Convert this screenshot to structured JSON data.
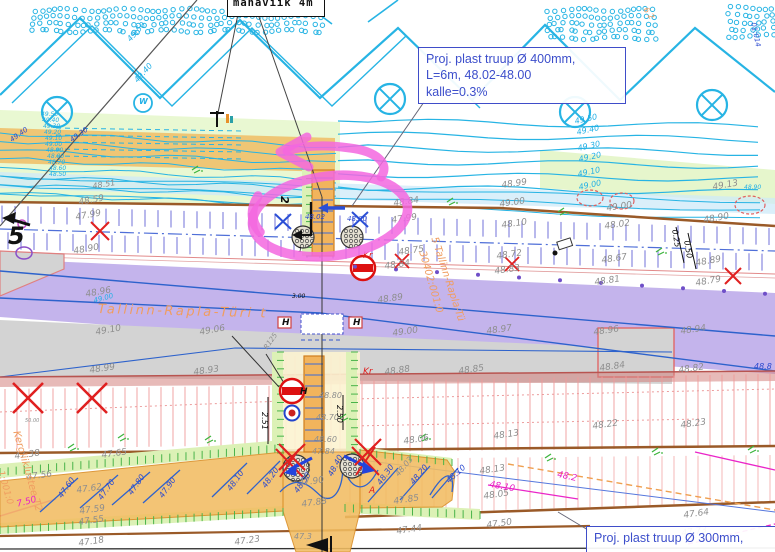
{
  "title_box": {
    "text": "mahaviik 4m"
  },
  "callout_400": {
    "line1": "Proj. plast truup Ø 400mm,",
    "line2": "L=6m, 48.02-48.00",
    "line3": "kalle=0.3%"
  },
  "callout_300": {
    "text": "Proj. plast truup Ø 300mm,"
  },
  "palette": {
    "gray_text": "#8e8e8e",
    "contour_cyan": "#23b0e6",
    "blue_text": "#2b49cf",
    "orange_text": "#f09d60",
    "red_text": "#e02020",
    "black_text": "#111111",
    "magenta_text": "#e822c6",
    "pink_annotation": "#f367df",
    "purple_road": "#b7a3e8",
    "orange_road": "#f2bd62",
    "gray_surface": "#d3d3d3",
    "callout_blue": "#3c4ecb"
  },
  "road_names": {
    "main_road": "Tallinn-Rapla-Türi t",
    "main_road_diagonal": "5 Tallinn-Rapla-Tü",
    "cadastral_main": "30402:001:0",
    "light_traffic_road": "Kergliiklustee T2",
    "cadastral_left": "1:001:0"
  },
  "labels": [
    {
      "t": "48.59",
      "x": 78,
      "y": 199,
      "c": "g",
      "r": -10
    },
    {
      "t": "47.99",
      "x": 75,
      "y": 214,
      "c": "g",
      "r": -10
    },
    {
      "t": "48.90",
      "x": 73,
      "y": 248,
      "c": "g",
      "r": -10
    },
    {
      "t": "48.96",
      "x": 85,
      "y": 291,
      "c": "g",
      "r": -10
    },
    {
      "t": "49.10",
      "x": 95,
      "y": 329,
      "c": "g",
      "r": -10
    },
    {
      "t": "49.06",
      "x": 199,
      "y": 329,
      "c": "g",
      "r": -10
    },
    {
      "t": "48.99",
      "x": 89,
      "y": 367,
      "c": "g",
      "r": -8
    },
    {
      "t": "48.93",
      "x": 193,
      "y": 369,
      "c": "g",
      "r": -8
    },
    {
      "t": "48.51",
      "x": 92,
      "y": 183,
      "c": "g",
      "s": 8,
      "r": -10
    },
    {
      "t": "48.89",
      "x": 377,
      "y": 297,
      "c": "g",
      "r": -8
    },
    {
      "t": "49.00",
      "x": 392,
      "y": 330,
      "c": "g",
      "r": -8
    },
    {
      "t": "48.97",
      "x": 486,
      "y": 328,
      "c": "g",
      "r": -8
    },
    {
      "t": "48.96",
      "x": 593,
      "y": 329,
      "c": "g",
      "r": -8
    },
    {
      "t": "48.99",
      "x": 501,
      "y": 182,
      "c": "g",
      "r": -8
    },
    {
      "t": "49.00",
      "x": 499,
      "y": 201,
      "c": "g",
      "r": -8
    },
    {
      "t": "49.00",
      "x": 606,
      "y": 205,
      "c": "g",
      "r": -8
    },
    {
      "t": "48.10",
      "x": 501,
      "y": 222,
      "c": "g",
      "r": -8
    },
    {
      "t": "48.02",
      "x": 604,
      "y": 223,
      "c": "g",
      "r": -8
    },
    {
      "t": "48.72",
      "x": 496,
      "y": 253,
      "c": "g",
      "r": -8
    },
    {
      "t": "48.75",
      "x": 398,
      "y": 249,
      "c": "g",
      "r": -8
    },
    {
      "t": "47.99",
      "x": 391,
      "y": 217,
      "c": "g",
      "r": -8
    },
    {
      "t": "48.84",
      "x": 393,
      "y": 200,
      "c": "g",
      "r": -8
    },
    {
      "t": "48.84",
      "x": 384,
      "y": 263,
      "c": "g",
      "r": -8
    },
    {
      "t": "48.83",
      "x": 494,
      "y": 268,
      "c": "g",
      "r": -8
    },
    {
      "t": "48.67",
      "x": 601,
      "y": 257,
      "c": "g",
      "r": -8
    },
    {
      "t": "49.13",
      "x": 712,
      "y": 184,
      "c": "g",
      "r": -10
    },
    {
      "t": "48.90",
      "x": 703,
      "y": 217,
      "c": "g",
      "r": -10
    },
    {
      "t": "48.89",
      "x": 695,
      "y": 260,
      "c": "g",
      "r": -10
    },
    {
      "t": "48.79",
      "x": 695,
      "y": 280,
      "c": "g",
      "r": -10
    },
    {
      "t": "48.81",
      "x": 594,
      "y": 279,
      "c": "g",
      "r": -8
    },
    {
      "t": "48.94",
      "x": 680,
      "y": 328,
      "c": "g",
      "r": -8
    },
    {
      "t": "48.84",
      "x": 599,
      "y": 365,
      "c": "g",
      "r": -8
    },
    {
      "t": "48.82",
      "x": 678,
      "y": 367,
      "c": "g",
      "r": -8
    },
    {
      "t": "48.88",
      "x": 384,
      "y": 369,
      "c": "g",
      "r": -8
    },
    {
      "t": "48.85",
      "x": 458,
      "y": 368,
      "c": "g",
      "r": -8
    },
    {
      "t": "48.80",
      "x": 319,
      "y": 392,
      "c": "g",
      "s": 8
    },
    {
      "t": "48.70",
      "x": 316,
      "y": 414,
      "c": "g",
      "s": 8
    },
    {
      "t": "48.60",
      "x": 314,
      "y": 436,
      "c": "g",
      "s": 8
    },
    {
      "t": "47.84",
      "x": 312,
      "y": 448,
      "c": "g",
      "s": 8
    },
    {
      "t": "47.90",
      "x": 298,
      "y": 480,
      "c": "g",
      "r": -8
    },
    {
      "t": "47.88",
      "x": 301,
      "y": 501,
      "c": "g",
      "r": -8
    },
    {
      "t": "47.85",
      "x": 393,
      "y": 498,
      "c": "g",
      "r": -8
    },
    {
      "t": "47.44",
      "x": 396,
      "y": 528,
      "c": "g",
      "r": -8
    },
    {
      "t": "47.50",
      "x": 486,
      "y": 522,
      "c": "g",
      "r": -8
    },
    {
      "t": "48.06",
      "x": 403,
      "y": 438,
      "c": "g",
      "r": -8
    },
    {
      "t": "48.13",
      "x": 493,
      "y": 433,
      "c": "g",
      "r": -8
    },
    {
      "t": "48.13",
      "x": 479,
      "y": 468,
      "c": "g",
      "r": -8
    },
    {
      "t": "48.05",
      "x": 483,
      "y": 493,
      "c": "g",
      "r": -8
    },
    {
      "t": "48.23",
      "x": 680,
      "y": 422,
      "c": "g",
      "r": -8
    },
    {
      "t": "48.22",
      "x": 592,
      "y": 423,
      "c": "g",
      "r": -8
    },
    {
      "t": "47.38",
      "x": 14,
      "y": 453,
      "c": "g",
      "r": -8
    },
    {
      "t": "47.65",
      "x": 101,
      "y": 452,
      "c": "g",
      "r": -8
    },
    {
      "t": "47.56",
      "x": 26,
      "y": 474,
      "c": "g",
      "r": -8
    },
    {
      "t": "47.62",
      "x": 76,
      "y": 487,
      "c": "g",
      "r": -8
    },
    {
      "t": "47.59",
      "x": 79,
      "y": 508,
      "c": "g",
      "r": -8
    },
    {
      "t": "47.55",
      "x": 78,
      "y": 519,
      "c": "g",
      "r": -8
    },
    {
      "t": "47.18",
      "x": 78,
      "y": 540,
      "c": "g",
      "r": -8
    },
    {
      "t": "47.23",
      "x": 234,
      "y": 539,
      "c": "g",
      "r": -8
    },
    {
      "t": "47.64",
      "x": 683,
      "y": 512,
      "c": "g",
      "r": -8
    },
    {
      "t": "47.73",
      "x": 681,
      "y": 530,
      "c": "g",
      "r": -8
    },
    {
      "t": "50.00",
      "x": 25,
      "y": 419,
      "c": "g",
      "s": 5
    },
    {
      "t": "R125",
      "x": 263,
      "y": 347,
      "c": "g",
      "s": 7,
      "r": -55
    },
    {
      "t": "47.3",
      "x": 294,
      "y": 533,
      "c": "g",
      "s": 8
    },
    {
      "t": "48.03",
      "x": 394,
      "y": 473,
      "c": "g",
      "s": 8,
      "r": -50
    },
    {
      "t": "49.50",
      "x": 574,
      "y": 118,
      "c": "c",
      "s": 8,
      "r": -12
    },
    {
      "t": "49.40",
      "x": 576,
      "y": 129,
      "c": "c",
      "s": 8,
      "r": -12
    },
    {
      "t": "49.30",
      "x": 577,
      "y": 145,
      "c": "c",
      "s": 8,
      "r": -12
    },
    {
      "t": "49.20",
      "x": 578,
      "y": 156,
      "c": "c",
      "s": 8,
      "r": -12
    },
    {
      "t": "49.10",
      "x": 577,
      "y": 171,
      "c": "c",
      "s": 8,
      "r": -12
    },
    {
      "t": "49.00",
      "x": 578,
      "y": 184,
      "c": "c",
      "s": 8,
      "r": -12
    },
    {
      "t": "49.50",
      "x": 126,
      "y": 38,
      "c": "c",
      "s": 8,
      "r": -48
    },
    {
      "t": "49.40",
      "x": 133,
      "y": 79,
      "c": "c",
      "s": 8,
      "r": -48
    },
    {
      "t": "48.90",
      "x": 744,
      "y": 185,
      "c": "c",
      "s": 6
    },
    {
      "t": "49.00",
      "x": 93,
      "y": 298,
      "c": "c",
      "s": 7,
      "r": -15
    },
    {
      "t": "W",
      "x": 139,
      "y": 98,
      "c": "c",
      "s": 8,
      "b": 1
    },
    {
      "t": "49.50",
      "x": 41,
      "y": 112,
      "c": "c",
      "s": 6
    },
    {
      "t": "49.40",
      "x": 42,
      "y": 118,
      "c": "c",
      "s": 6
    },
    {
      "t": "49.30",
      "x": 43,
      "y": 124,
      "c": "c",
      "s": 6
    },
    {
      "t": "49.20",
      "x": 44,
      "y": 130,
      "c": "c",
      "s": 6
    },
    {
      "t": "49.10",
      "x": 45,
      "y": 136,
      "c": "c",
      "s": 6
    },
    {
      "t": "49.00",
      "x": 45,
      "y": 142,
      "c": "c",
      "s": 6
    },
    {
      "t": "48.90",
      "x": 46,
      "y": 148,
      "c": "c",
      "s": 6
    },
    {
      "t": "48.80",
      "x": 47,
      "y": 154,
      "c": "c",
      "s": 6
    },
    {
      "t": "48.70",
      "x": 48,
      "y": 160,
      "c": "c",
      "s": 6
    },
    {
      "t": "48.60",
      "x": 49,
      "y": 166,
      "c": "c",
      "s": 6
    },
    {
      "t": "48.50",
      "x": 49,
      "y": 172,
      "c": "c",
      "s": 6
    },
    {
      "t": "49.40",
      "x": 9,
      "y": 138,
      "c": "b",
      "s": 7,
      "r": -35
    },
    {
      "t": "49.30",
      "x": 69,
      "y": 138,
      "c": "b",
      "s": 7,
      "r": -35
    },
    {
      "t": "48.02",
      "x": 305,
      "y": 214,
      "c": "b",
      "s": 7
    },
    {
      "t": "48.00",
      "x": 347,
      "y": 216,
      "c": "b",
      "s": 7
    },
    {
      "t": "47.60",
      "x": 57,
      "y": 495,
      "c": "b",
      "s": 8,
      "r": -55
    },
    {
      "t": "47.70",
      "x": 97,
      "y": 497,
      "c": "b",
      "s": 8,
      "r": -55
    },
    {
      "t": "47.80",
      "x": 127,
      "y": 492,
      "c": "b",
      "s": 8,
      "r": -55
    },
    {
      "t": "47.90",
      "x": 158,
      "y": 495,
      "c": "b",
      "s": 8,
      "r": -55
    },
    {
      "t": "48.10",
      "x": 226,
      "y": 488,
      "c": "b",
      "s": 8,
      "r": -55
    },
    {
      "t": "48.20",
      "x": 261,
      "y": 485,
      "c": "b",
      "s": 8,
      "r": -55
    },
    {
      "t": "48.30",
      "x": 293,
      "y": 490,
      "c": "b",
      "s": 8,
      "r": -55
    },
    {
      "t": "48.40",
      "x": 327,
      "y": 474,
      "c": "b",
      "s": 8,
      "r": -62
    },
    {
      "t": "48.30",
      "x": 376,
      "y": 482,
      "c": "b",
      "s": 8,
      "r": -55
    },
    {
      "t": "48.20",
      "x": 409,
      "y": 481,
      "c": "b",
      "s": 8,
      "r": -50
    },
    {
      "t": "48.10",
      "x": 445,
      "y": 479,
      "c": "b",
      "s": 8,
      "r": -42
    },
    {
      "t": "48.8",
      "x": 754,
      "y": 363,
      "c": "b",
      "s": 8
    },
    {
      "t": "01:014",
      "x": 756,
      "y": 22,
      "c": "b",
      "s": 7,
      "r": 78
    },
    {
      "t": "Tallinn-Rapla-Türi t",
      "x": 98,
      "y": 303,
      "c": "o",
      "s": 13,
      "r": 1.5,
      "ls": 2.5
    },
    {
      "t": "5 Tallinn-Rapla-Tü",
      "x": 438,
      "y": 236,
      "c": "o",
      "s": 10,
      "r": 72
    },
    {
      "t": "30402:001:0",
      "x": 426,
      "y": 250,
      "c": "o",
      "s": 10,
      "r": 74
    },
    {
      "t": "Kergliiklustee T2",
      "x": 20,
      "y": 430,
      "c": "o",
      "s": 10,
      "r": 74
    },
    {
      "t": "1:001:0",
      "x": 4,
      "y": 470,
      "c": "o",
      "s": 9,
      "r": 74
    },
    {
      "t": "6 2",
      "x": 648,
      "y": 6,
      "c": "o",
      "s": 8,
      "r": 55
    },
    {
      "t": "Kr",
      "x": 363,
      "y": 252,
      "c": "r",
      "s": 9
    },
    {
      "t": "Kr",
      "x": 363,
      "y": 368,
      "c": "r",
      "s": 9
    },
    {
      "t": "A",
      "x": 369,
      "y": 487,
      "c": "r",
      "s": 9
    },
    {
      "t": "5",
      "x": 8,
      "y": 224,
      "c": "k",
      "s": 24,
      "b": 1
    },
    {
      "t": "2",
      "x": 290,
      "y": 196,
      "c": "k",
      "s": 11,
      "r": 90,
      "b": 1
    },
    {
      "t": "H",
      "x": 282,
      "y": 319,
      "c": "k",
      "s": 9,
      "b": 1
    },
    {
      "t": "H",
      "x": 353,
      "y": 319,
      "c": "k",
      "s": 9,
      "b": 1
    },
    {
      "t": "H",
      "x": 300,
      "y": 388,
      "c": "k",
      "s": 9,
      "b": 1
    },
    {
      "t": "2.51",
      "x": 268,
      "y": 412,
      "c": "k",
      "s": 8,
      "r": 90
    },
    {
      "t": "2.50",
      "x": 343,
      "y": 405,
      "c": "k",
      "s": 8,
      "r": 90
    },
    {
      "t": "0.25",
      "x": 678,
      "y": 229,
      "c": "k",
      "s": 8,
      "r": 80
    },
    {
      "t": "0.50",
      "x": 690,
      "y": 240,
      "c": "k",
      "s": 8,
      "r": 80
    },
    {
      "t": "3.00",
      "x": 292,
      "y": 294,
      "c": "k",
      "s": 6
    },
    {
      "t": "1",
      "x": 298,
      "y": 247,
      "c": "k",
      "s": 7
    },
    {
      "t": "7.50",
      "x": 16,
      "y": 501,
      "c": "m",
      "s": 9,
      "r": -15
    },
    {
      "t": "48.10",
      "x": 490,
      "y": 481,
      "c": "m",
      "s": 9,
      "r": 10
    },
    {
      "t": "48.2",
      "x": 558,
      "y": 471,
      "c": "m",
      "s": 9,
      "r": 12
    }
  ]
}
